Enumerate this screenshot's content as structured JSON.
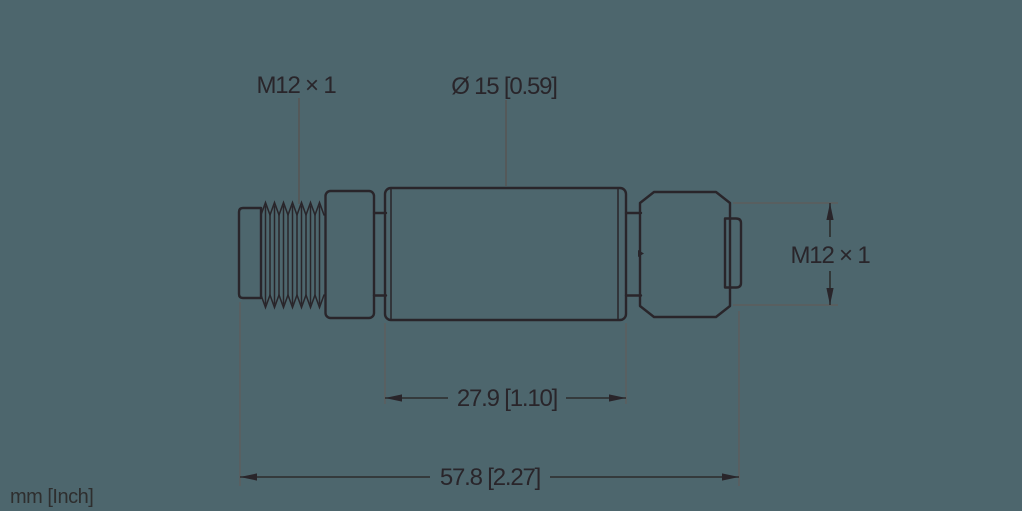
{
  "drawing": {
    "type": "technical-dimension-drawing",
    "subject": "M12 inline adapter side view",
    "colors": {
      "background": "#4d666d",
      "line": "#29252a",
      "auxiliary_line": "#5d5d5d"
    },
    "labels": {
      "thread_left": "M12 × 1",
      "diameter": "Ø 15 [0.59]",
      "thread_right": "M12 × 1"
    },
    "dimensions": {
      "body_length": "27.9 [1.10]",
      "total_length": "57.8 [2.27]"
    },
    "units_note": "mm [Inch]"
  }
}
